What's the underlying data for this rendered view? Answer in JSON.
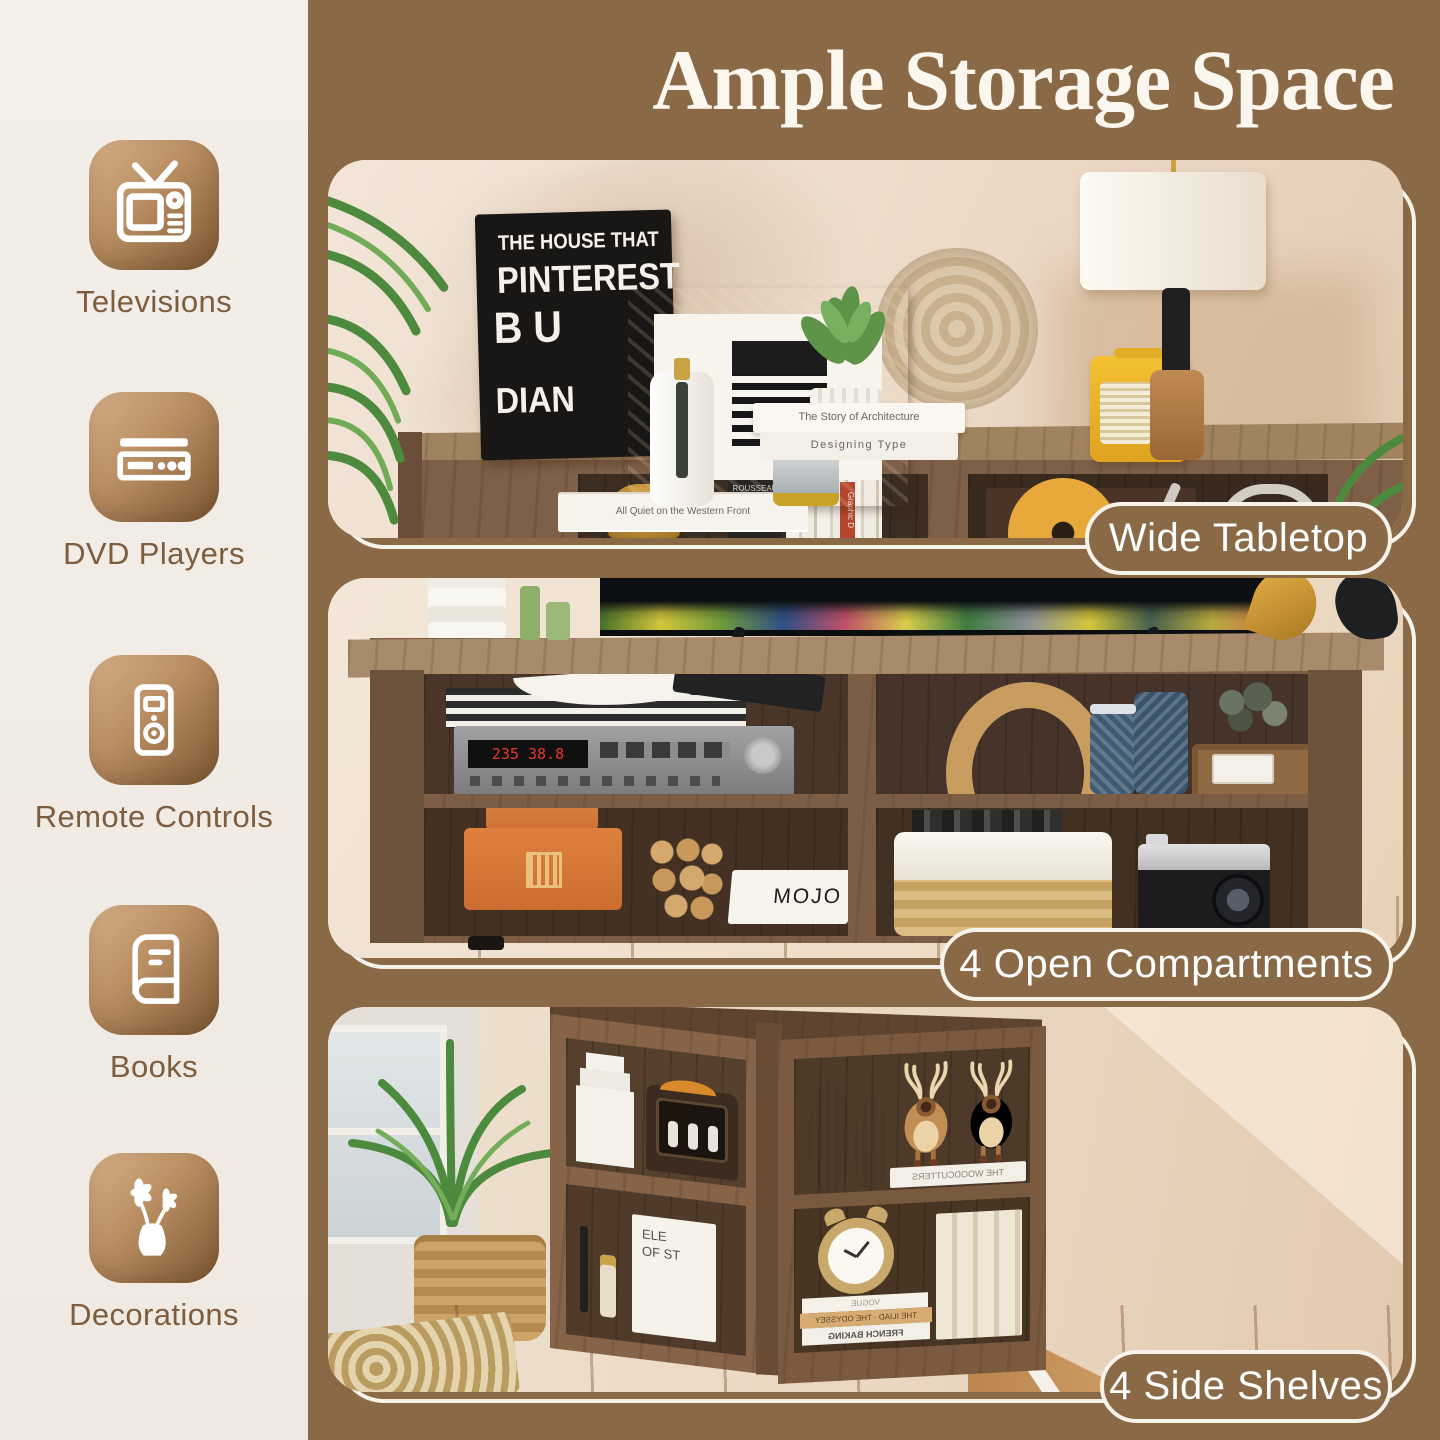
{
  "title": "Ample Storage Space",
  "colors": {
    "background_brown": "#8a6946",
    "sidebar_cream": "#f2ece5",
    "label_brown": "#7d5d3e",
    "badge_fill": "#8a6946",
    "badge_border": "#f7f2ea",
    "title_cream": "#fcf7ee",
    "icon_gradient_start": "#d6b088",
    "icon_gradient_end": "#7d5833"
  },
  "sidebar": {
    "items": [
      {
        "icon": "tv-icon",
        "label": "Televisions"
      },
      {
        "icon": "dvd-player-icon",
        "label": "DVD Players"
      },
      {
        "icon": "remote-control-icon",
        "label": "Remote Controls"
      },
      {
        "icon": "book-icon",
        "label": "Books"
      },
      {
        "icon": "vase-flowers-icon",
        "label": "Decorations"
      }
    ]
  },
  "photos": [
    {
      "badge": "Wide Tabletop",
      "scene": {
        "sign": {
          "line1": "THE HOUSE THAT",
          "line2": "PINTEREST",
          "line3": "B U",
          "line4": "DIAN"
        },
        "book_stack": {
          "top": "The Story of Architecture",
          "bottom": "Designing Type"
        },
        "spine_small": "All Quiet on the Western Front",
        "shelf_books": [
          "ROUSSEAU",
          "Graphic D"
        ]
      }
    },
    {
      "badge": "4 Open Compartments",
      "scene": {
        "receiver_display": "235 38.8",
        "mojo_book": "MOJO"
      }
    },
    {
      "badge": "4 Side Shelves",
      "scene": {
        "book_cover_line1": "ELE",
        "book_cover_line2": "OF ST",
        "reindeer_book": "THE WOODCUTTERS",
        "clock_books": [
          "VOGUE",
          "THE ILIAD · THE ODYSSEY",
          "FRENCH BAKING"
        ]
      }
    }
  ]
}
